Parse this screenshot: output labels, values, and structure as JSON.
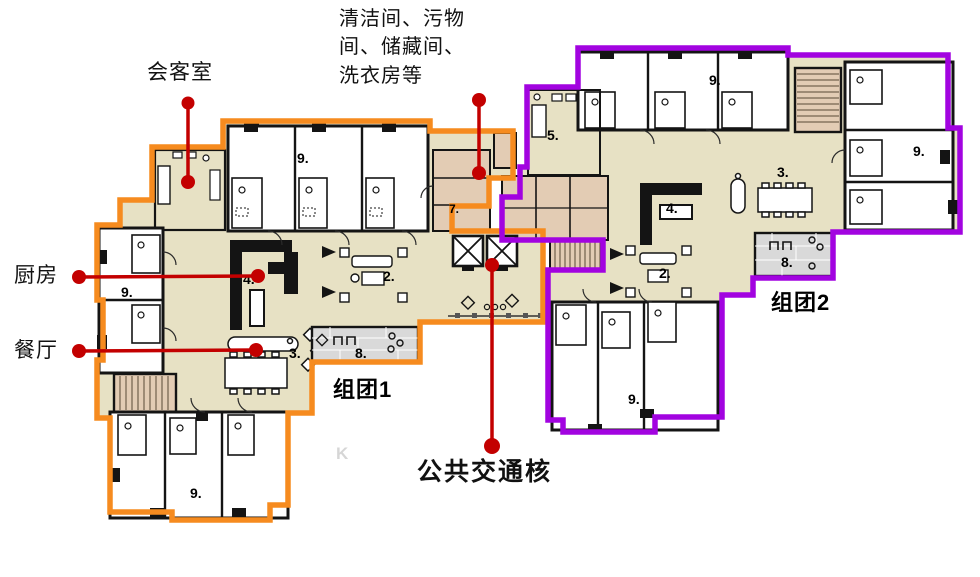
{
  "colors": {
    "cluster1_outline": "#F68B1F",
    "cluster2_outline": "#A203E0",
    "annotation_red": "#C30000",
    "floor": "#E7E1C4",
    "service_floor": "#E3CCB4",
    "terrace": "#D9D9D9",
    "wall": "#141414"
  },
  "labels": {
    "meeting_room": "会客室",
    "service_rooms": "清洁间、污物\n间、储藏间、\n洗衣房等",
    "kitchen": "厨房",
    "dining_room": "餐厅",
    "transport_core": "公共交通核",
    "cluster1": "组团1",
    "cluster2": "组团2",
    "watermark": "K"
  },
  "room_labels": [
    {
      "id": "c1-bedrooms-top",
      "text": "9."
    },
    {
      "id": "c1-service-room",
      "text": "7."
    },
    {
      "id": "c1-living",
      "text": "2."
    },
    {
      "id": "c1-dining",
      "text": "3."
    },
    {
      "id": "c1-kitchen",
      "text": "4."
    },
    {
      "id": "c1-terrace",
      "text": "8."
    },
    {
      "id": "c1-bedrooms-left",
      "text": "9."
    },
    {
      "id": "c1-bedrooms-bottom",
      "text": "9."
    },
    {
      "id": "c2-room5",
      "text": "5."
    },
    {
      "id": "c2-bedrooms-top",
      "text": "9."
    },
    {
      "id": "c2-bedrooms-right",
      "text": "9."
    },
    {
      "id": "c2-dining",
      "text": "3."
    },
    {
      "id": "c2-kitchen",
      "text": "4."
    },
    {
      "id": "c2-living",
      "text": "2."
    },
    {
      "id": "c2-terrace",
      "text": "8."
    },
    {
      "id": "c2-bedrooms-bottom",
      "text": "9."
    }
  ]
}
